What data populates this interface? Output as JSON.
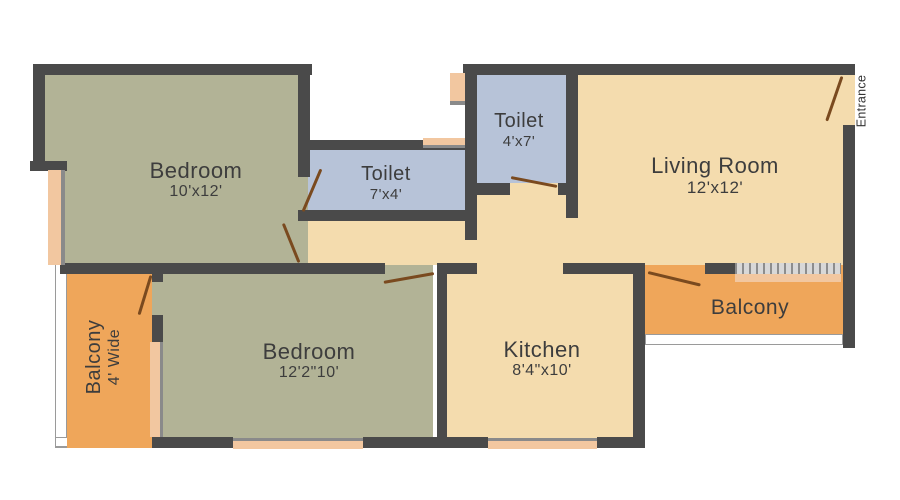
{
  "title": "2BHK Apartment Floor Plan",
  "colors": {
    "wall": "#4a4a4a",
    "bedroom": "#b2b396",
    "toilet": "#b7c3d8",
    "living": "#f4dcae",
    "balcony": "#efa65a",
    "window": "#f2c7a0",
    "door": "#7a4a1f",
    "text": "#3d3d3d",
    "rail": "#9a9a9a"
  },
  "rooms": [
    {
      "id": "bedroom-1",
      "name": "Bedroom",
      "size": "10'x12'"
    },
    {
      "id": "toilet-1",
      "name": "Toilet",
      "size": "7'x4'"
    },
    {
      "id": "toilet-2",
      "name": "Toilet",
      "size": "4'x7'"
    },
    {
      "id": "living-room",
      "name": "Living Room",
      "size": "12'x12'"
    },
    {
      "id": "bedroom-2",
      "name": "Bedroom",
      "size": "12'2\"10'"
    },
    {
      "id": "kitchen",
      "name": "Kitchen",
      "size": "8'4\"x10'"
    },
    {
      "id": "balcony-right",
      "name": "Balcony",
      "size": ""
    },
    {
      "id": "balcony-left",
      "name": "Balcony",
      "size": "4' Wide"
    }
  ],
  "annotations": {
    "entrance": "Entrance"
  }
}
